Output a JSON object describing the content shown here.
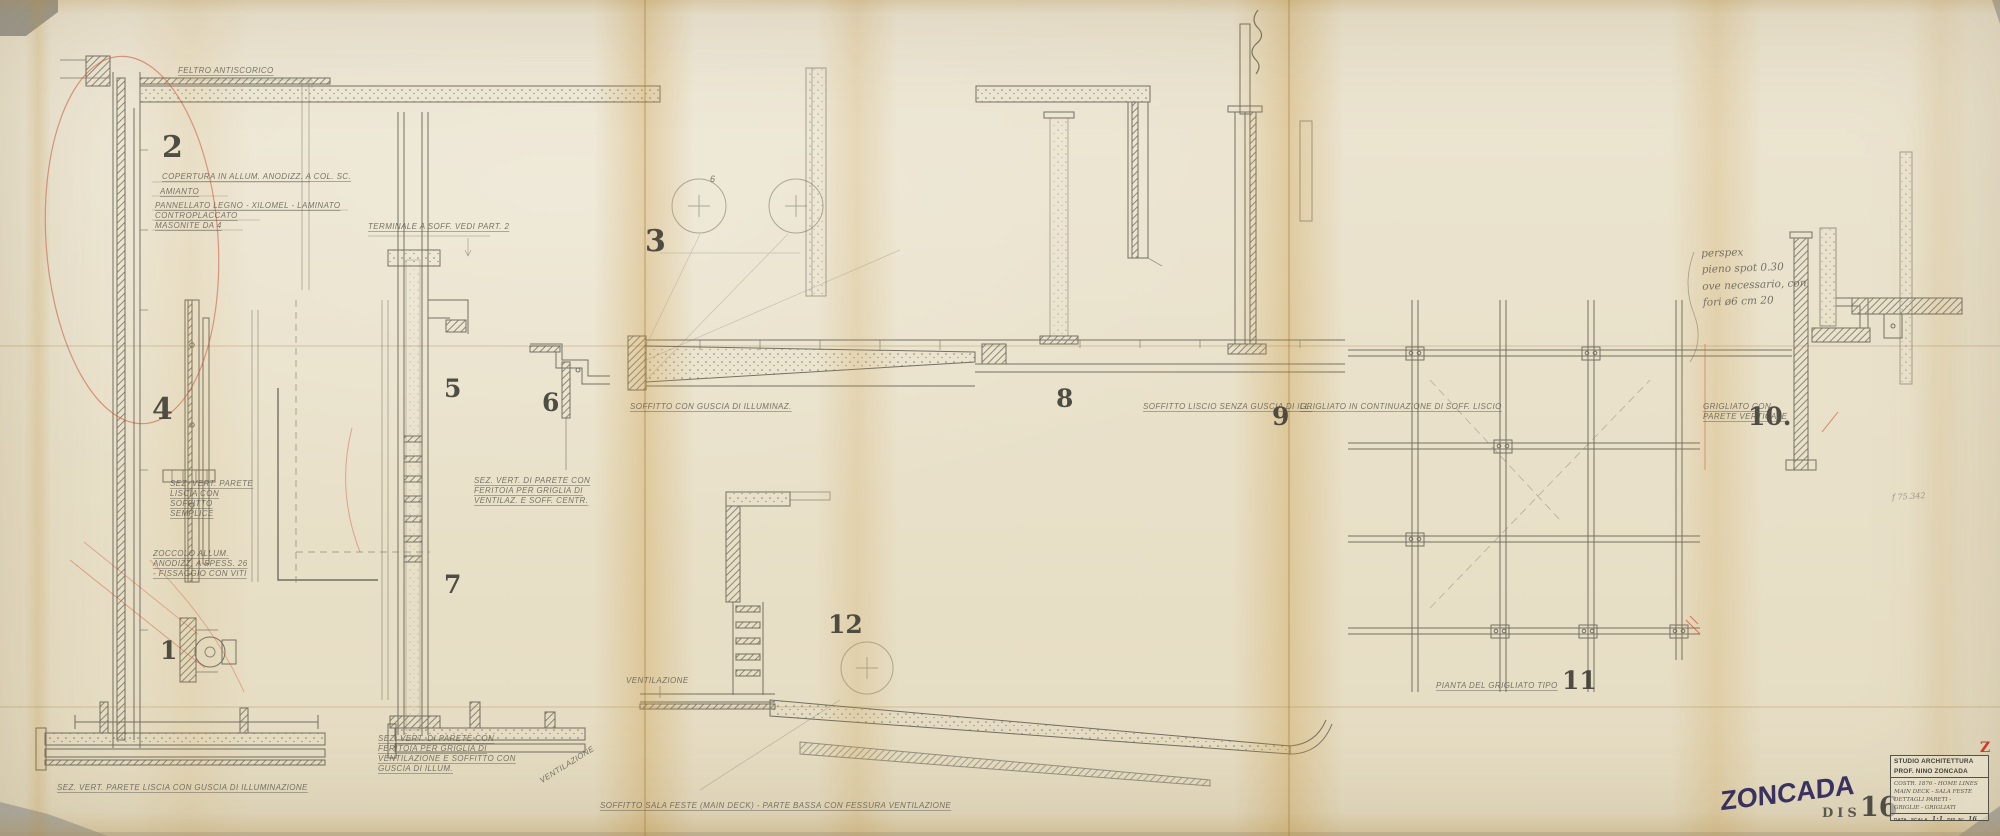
{
  "sheet": {
    "colors": {
      "paper": "#e9e1ca",
      "stain": "#c99a3e",
      "graphite": "#5f5b50",
      "red_pencil": "#c8432e",
      "stamp_ink": "#2b2358"
    }
  },
  "detail_numbers": [
    "1",
    "2",
    "3",
    "4",
    "5",
    "6",
    "7",
    "8",
    "9",
    "10.",
    "11",
    "12"
  ],
  "annotations": {
    "feltro": "FELTRO ANTISCORICO",
    "copertura": "COPERTURA IN ALLUM. ANODIZZ. A COL. SC.",
    "amianto": "AMIANTO",
    "pannellato": "PANNELLATO LEGNO - XILOMEL - LAMINATO",
    "controplaccato": "CONTROPLACCATO",
    "masonite": "MASONITE DA 4",
    "terminale": "TERMINALE A SOFF. VEDI PART. 2",
    "sez_parete_liscia": "SEZ. VERT. PARETE LISCIA CON SOFFITTO SEMPLICE",
    "zoccolo": "ZOCCOLO ALLUM. ANODIZZ. A SPESS. 26 - FISSAGGIO CON VITI",
    "sez_guscia": "SEZ. VERT. PARETE LISCIA CON GUSCIA DI ILLUMINAZIONE",
    "sez_feritoia_presa": "SEZ. VERT. DI PARETE CON FERITOIA PER GRIGLIA DI VENTILAZ. E SOFF. CENTR.",
    "sez_feritoia_griglia": "SEZ. VERT. DI PARETE CON FERITOIA PER GRIGLIA DI VENTILAZIONE E SOFFITTO CON GUSCIA DI ILLUM.",
    "soffitto_guscia": "SOFFITTO CON GUSCIA DI ILLUMINAZ.",
    "soffitto_liscio": "SOFFITTO LISCIO SENZA GUSCIA DI ILL.",
    "grigliato_cont": "GRIGLIATO IN CONTINUAZIONE DI SOFF. LISCIO",
    "grigliato_parete": "GRIGLIATO CON PARETE VERTICALE",
    "pianta_grigliato": "PIANTA DEL GRIGLIATO TIPO",
    "soffitto_sala": "SOFFITTO SALA FESTE (MAIN DECK) - PARTE BASSA CON FESSURA VENTILAZIONE",
    "ventilazione": "VENTILAZIONE",
    "ventilazione_diag": "VENTILAZIONE",
    "guide_number": "6",
    "pencil_ref": "f 75.342"
  },
  "handwritten_note": {
    "l1": "perspex",
    "l2": "pieno spot 0.30",
    "l3": "ove necessario, con",
    "l4": "fori ø6 cm 20"
  },
  "stamps": {
    "zoncada": "ZONCADA",
    "dis": "DIS",
    "dis_number": "16",
    "red_mark": "Z"
  },
  "title_block": {
    "line1": "STUDIO ARCHITETTURA",
    "line2": "PROF. NINO ZONCADA",
    "job1": "COSTR. 1876 - HOME LINES",
    "job2": "MAIN DECK - SALA FESTE",
    "job3": "DETTAGLI PARETI -",
    "job4": "GRIGLIE - GRIGLIATI",
    "data_label": "DATA",
    "scala_label": "SCALA",
    "scala_value": "1:1",
    "disnp_label": "DIS. N°",
    "disnp_value": "16"
  }
}
